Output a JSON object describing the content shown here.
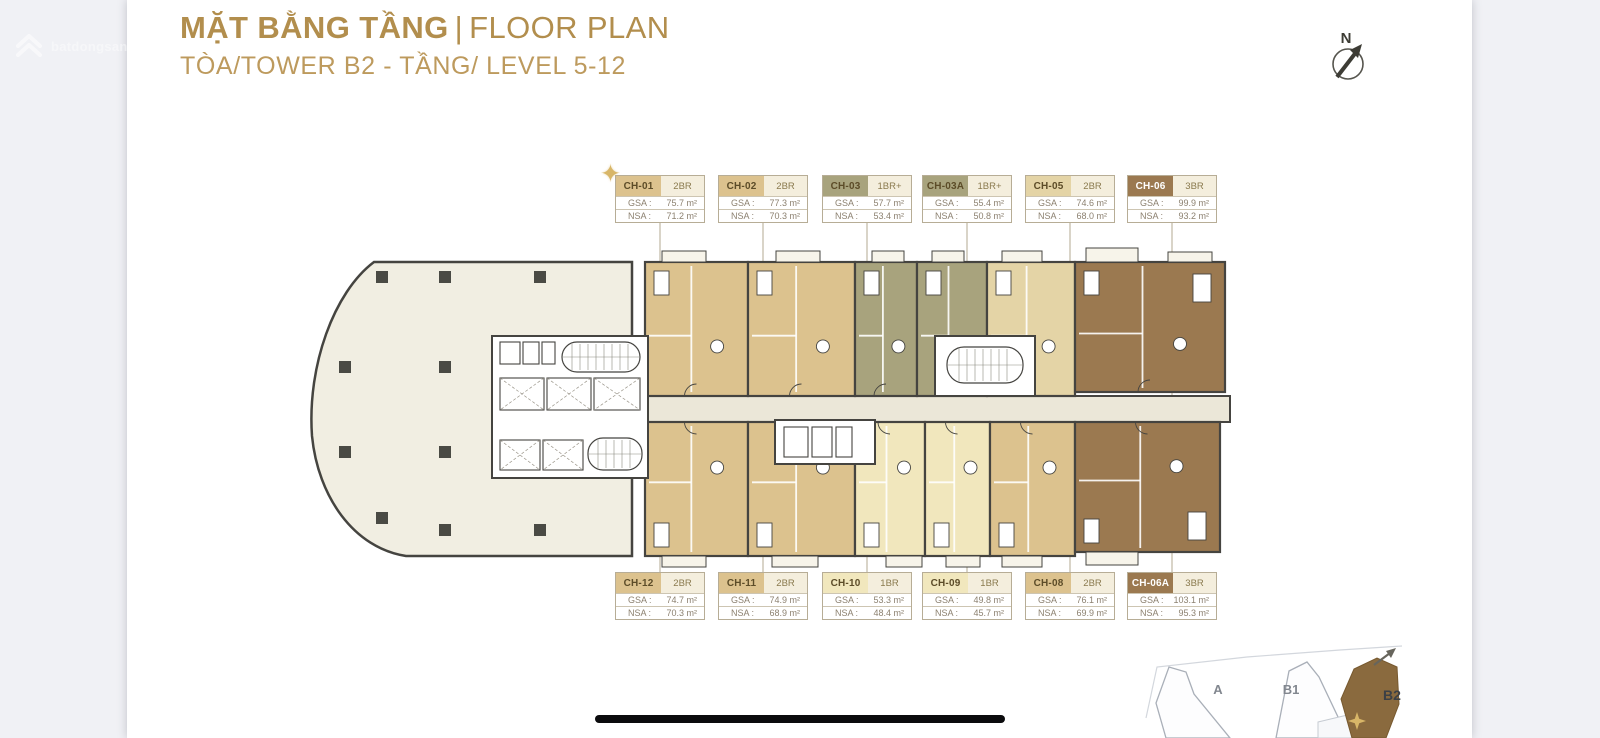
{
  "page": {
    "background": "#f0f1f5",
    "canvas_background": "#ffffff",
    "home_indicator_color": "#0b0b0d"
  },
  "watermark": {
    "icon": "brand-chevron-logo-icon",
    "text": "batdongsan.com.vn"
  },
  "header": {
    "title_vi": "MẶT BẰNG TẦNG",
    "separator": "|",
    "title_en": "FLOOR PLAN",
    "subtitle": "TÒA/TOWER B2 - TẦNG/ LEVEL 5-12",
    "title_color": "#b28e4d",
    "subtitle_color": "#bd9a5d"
  },
  "compass": {
    "label": "N"
  },
  "labels": {
    "gsa": "GSA :",
    "nsa": "NSA :"
  },
  "palette": {
    "tan": "#dcc28e",
    "tan_light": "#e4d4a6",
    "olive": "#a8a37d",
    "pale": "#f1e7bd",
    "brown": "#9b7950",
    "brown2": "#8a6a3e",
    "floor": "#f1eee2",
    "corridor": "#ebe7d8",
    "wall": "#454440"
  },
  "units_top": [
    {
      "id": "CH-01",
      "type": "2BR",
      "gsa": "75.7 m²",
      "nsa": "71.2 m²",
      "color": "tan",
      "starred": true
    },
    {
      "id": "CH-02",
      "type": "2BR",
      "gsa": "77.3 m²",
      "nsa": "70.3 m²",
      "color": "tan",
      "starred": false
    },
    {
      "id": "CH-03",
      "type": "1BR+",
      "gsa": "57.7 m²",
      "nsa": "53.4 m²",
      "color": "olive",
      "starred": false
    },
    {
      "id": "CH-03A",
      "type": "1BR+",
      "gsa": "55.4 m²",
      "nsa": "50.8 m²",
      "color": "olive",
      "starred": false
    },
    {
      "id": "CH-05",
      "type": "2BR",
      "gsa": "74.6 m²",
      "nsa": "68.0 m²",
      "color": "tan_light",
      "starred": false
    },
    {
      "id": "CH-06",
      "type": "3BR",
      "gsa": "99.9 m²",
      "nsa": "93.2 m²",
      "color": "brown",
      "starred": false
    }
  ],
  "units_bottom": [
    {
      "id": "CH-12",
      "type": "2BR",
      "gsa": "74.7 m²",
      "nsa": "70.3 m²",
      "color": "tan",
      "starred": false
    },
    {
      "id": "CH-11",
      "type": "2BR",
      "gsa": "74.9 m²",
      "nsa": "68.9 m²",
      "color": "tan",
      "starred": false
    },
    {
      "id": "CH-10",
      "type": "1BR",
      "gsa": "53.3 m²",
      "nsa": "48.4 m²",
      "color": "pale",
      "starred": false
    },
    {
      "id": "CH-09",
      "type": "1BR",
      "gsa": "49.8 m²",
      "nsa": "45.7 m²",
      "color": "pale",
      "starred": false
    },
    {
      "id": "CH-08",
      "type": "2BR",
      "gsa": "76.1 m²",
      "nsa": "69.9 m²",
      "color": "tan",
      "starred": false
    },
    {
      "id": "CH-06A",
      "type": "3BR",
      "gsa": "103.1 m²",
      "nsa": "95.3 m²",
      "color": "brown",
      "starred": false
    }
  ],
  "plan": {
    "units": [
      {
        "id": "CH-01",
        "row": "top",
        "x": 645,
        "y": 262,
        "w": 103,
        "h": 134,
        "color": "tan"
      },
      {
        "id": "CH-02",
        "row": "top",
        "x": 748,
        "y": 262,
        "w": 107,
        "h": 134,
        "color": "tan"
      },
      {
        "id": "CH-03",
        "row": "top",
        "x": 855,
        "y": 262,
        "w": 62,
        "h": 134,
        "color": "olive"
      },
      {
        "id": "CH-03A",
        "row": "top",
        "x": 917,
        "y": 262,
        "w": 70,
        "h": 134,
        "color": "olive"
      },
      {
        "id": "CH-05",
        "row": "top",
        "x": 987,
        "y": 262,
        "w": 88,
        "h": 134,
        "color": "tan_light"
      },
      {
        "id": "CH-06",
        "row": "top",
        "x": 1075,
        "y": 262,
        "w": 150,
        "h": 130,
        "color": "brown"
      },
      {
        "id": "CH-12",
        "row": "bottom",
        "x": 645,
        "y": 422,
        "w": 103,
        "h": 134,
        "color": "tan"
      },
      {
        "id": "CH-11",
        "row": "bottom",
        "x": 748,
        "y": 422,
        "w": 107,
        "h": 134,
        "color": "tan"
      },
      {
        "id": "CH-10",
        "row": "bottom",
        "x": 855,
        "y": 422,
        "w": 70,
        "h": 134,
        "color": "pale"
      },
      {
        "id": "CH-09",
        "row": "bottom",
        "x": 925,
        "y": 422,
        "w": 65,
        "h": 134,
        "color": "pale"
      },
      {
        "id": "CH-08",
        "row": "bottom",
        "x": 990,
        "y": 422,
        "w": 85,
        "h": 134,
        "color": "tan"
      },
      {
        "id": "CH-06A",
        "row": "bottom",
        "x": 1075,
        "y": 422,
        "w": 145,
        "h": 130,
        "color": "brown"
      }
    ],
    "columns": [
      [
        382,
        277
      ],
      [
        445,
        277
      ],
      [
        540,
        277
      ],
      [
        345,
        367
      ],
      [
        445,
        367
      ],
      [
        345,
        452
      ],
      [
        445,
        452
      ],
      [
        382,
        518
      ],
      [
        445,
        530
      ],
      [
        540,
        530
      ]
    ]
  },
  "keyplan": {
    "towers": [
      {
        "label": "A"
      },
      {
        "label": "B1"
      },
      {
        "label": "B2",
        "highlighted": true
      }
    ],
    "highlight_color": "#8a6a3e",
    "star_color": "#d8b668"
  }
}
